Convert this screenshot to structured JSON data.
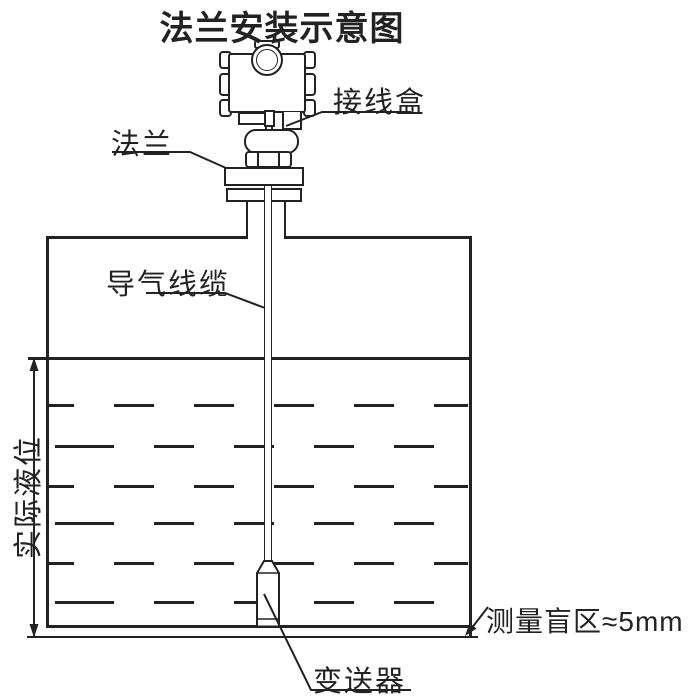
{
  "title": "法兰安装示意图",
  "labels": {
    "junction_box": "接线盒",
    "flange": "法兰",
    "air_cable": "导气线缆",
    "actual_level": "实际液位",
    "transmitter": "变送器",
    "blind_zone": "测量盲区≈5mm"
  },
  "colors": {
    "line": "#222222",
    "background": "#ffffff"
  }
}
